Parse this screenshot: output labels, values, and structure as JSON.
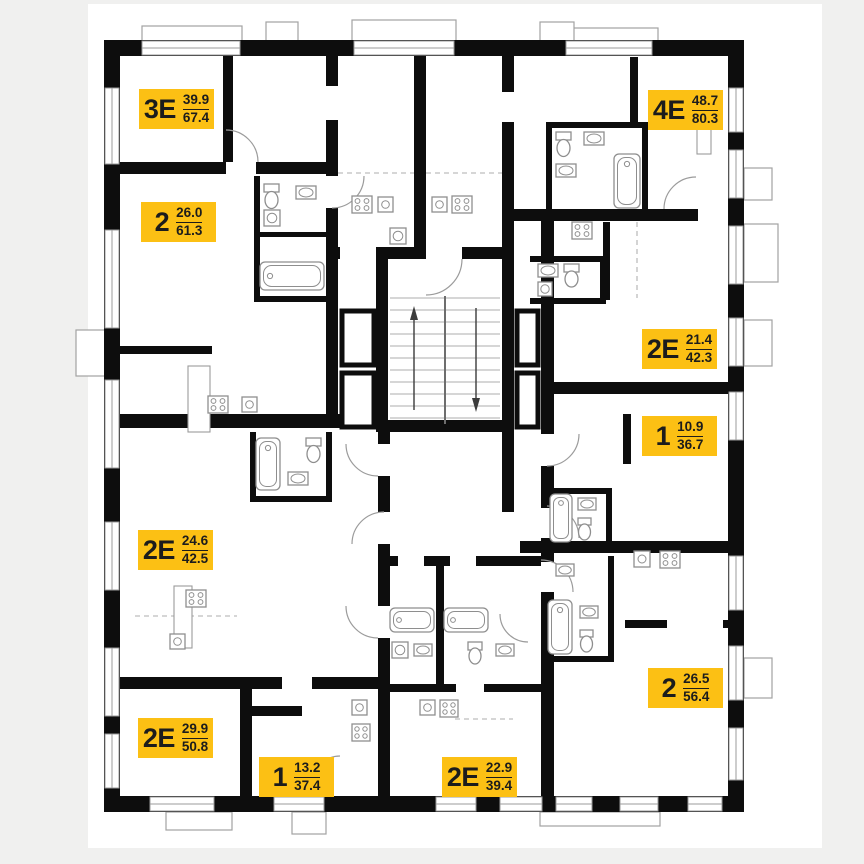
{
  "plan": {
    "colors": {
      "background": "#f0f0ef",
      "paper": "#ffffff",
      "wall": "#0d0d0d",
      "accent": "#fcc014",
      "line": "#9b9b9b"
    },
    "apartments": [
      {
        "type": "3Е",
        "area_living": "39.9",
        "area_total": "67.4"
      },
      {
        "type": "2",
        "area_living": "26.0",
        "area_total": "61.3"
      },
      {
        "type": "4Е",
        "area_living": "48.7",
        "area_total": "80.3"
      },
      {
        "type": "2Е",
        "area_living": "21.4",
        "area_total": "42.3"
      },
      {
        "type": "1",
        "area_living": "10.9",
        "area_total": "36.7"
      },
      {
        "type": "2Е",
        "area_living": "24.6",
        "area_total": "42.5"
      },
      {
        "type": "2Е",
        "area_living": "29.9",
        "area_total": "50.8"
      },
      {
        "type": "1",
        "area_living": "13.2",
        "area_total": "37.4"
      },
      {
        "type": "2Е",
        "area_living": "22.9",
        "area_total": "39.4"
      },
      {
        "type": "2",
        "area_living": "26.5",
        "area_total": "56.4"
      }
    ],
    "stairs": {
      "up_arrow": "↑",
      "down_arrow": "↓"
    }
  }
}
